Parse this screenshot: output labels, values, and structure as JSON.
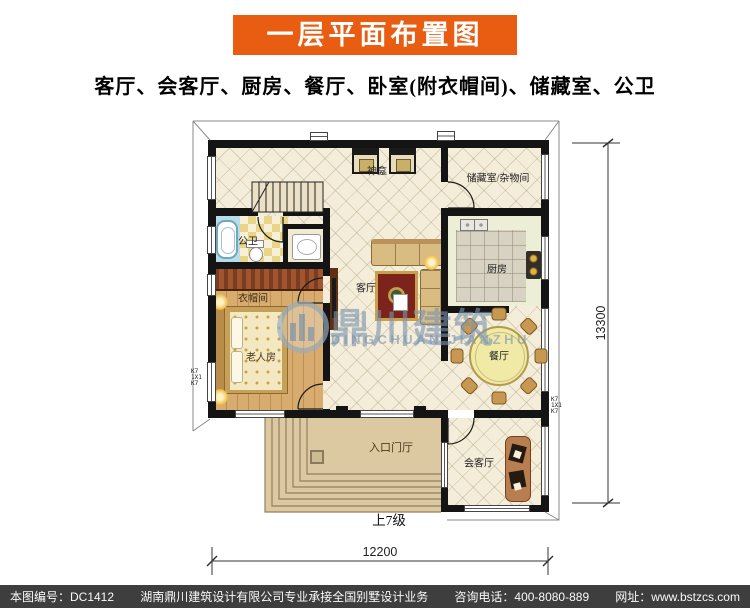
{
  "header": {
    "title": "一层平面布置图",
    "subtitle": "客厅、会客厅、厨房、餐厅、卧室(附衣帽间)、储藏室、公卫",
    "banner_color": "#e95d12"
  },
  "plan": {
    "rooms": {
      "shrine": "神龛",
      "storage": "储藏室/杂物间",
      "bathroom": "公卫",
      "closet": "衣帽间",
      "bedroom": "老人房",
      "living": "客厅",
      "kitchen": "厨房",
      "dining": "餐厅",
      "entry_hall": "入口门厅",
      "reception": "会客厅"
    },
    "annotations": {
      "steps": "上7级",
      "column_left": "K7\n1X1\nK7",
      "column_right": "K7\n1X1\nK7"
    },
    "dimensions": {
      "right": "13300",
      "bottom": "12200"
    }
  },
  "watermark": {
    "cn": "鼎川建筑",
    "en": "DINGCHUAN JIANZHU"
  },
  "footer": {
    "drawing_no": "本图编号：DC1412",
    "company": "湖南鼎川建筑设计有限公司专业承接全国别墅设计业务",
    "phone": "咨询电话：400-8080-889",
    "website": "网址：www.bstzcs.com"
  },
  "colors": {
    "banner": "#e95d12",
    "wall": "#141414",
    "footer_bg": "#3e3e3e",
    "floor_cream": "#f4edda",
    "floor_wood": "#d8ab6e"
  }
}
